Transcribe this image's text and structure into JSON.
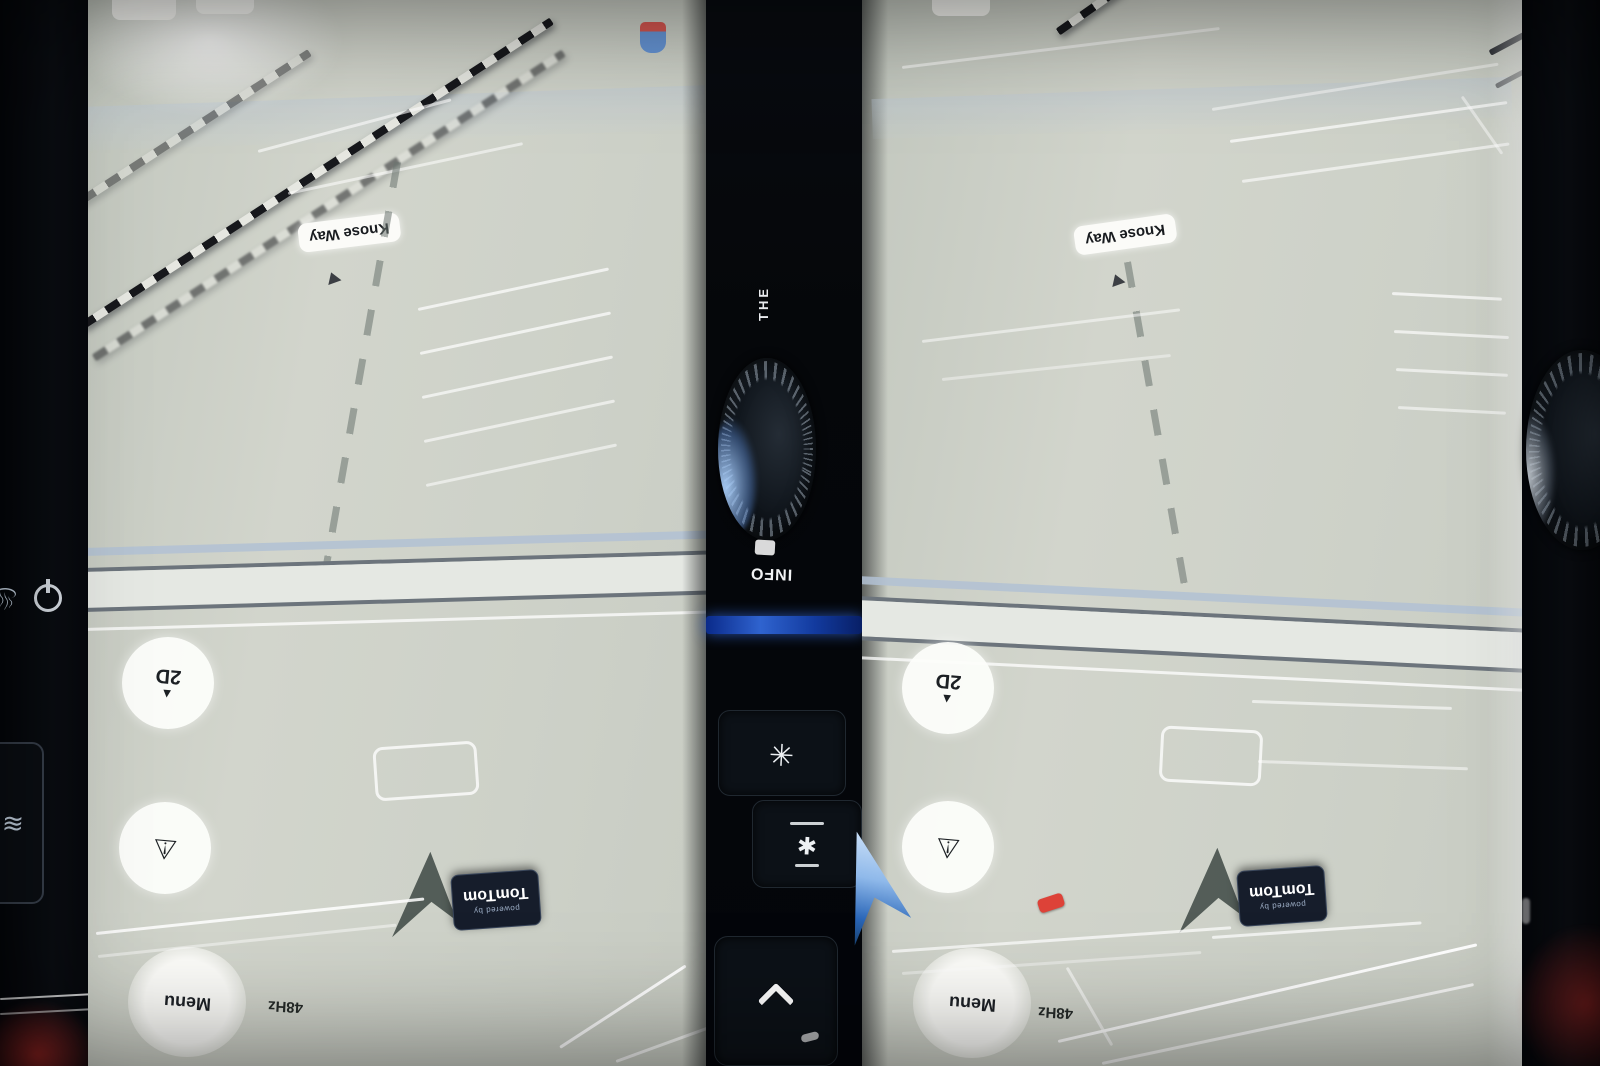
{
  "colors": {
    "map_background": "#cdd1c7",
    "bezel_black": "#06080b",
    "accent_blue": "#2f63cf",
    "chevron_blue": "#8fb9ea",
    "badge_background": "#161d2b",
    "alert_red": "#d84a44"
  },
  "map": {
    "road_label": "Knose Way",
    "compass_button_label": "2D",
    "menu_button_label": "Menu",
    "status_text": "48Hz",
    "badge_powered_by": "powered by",
    "badge_brand": "TomTom"
  },
  "console": {
    "vertical_text": "THE",
    "info_label": "INFO"
  },
  "icons": {
    "north_arrow": "▲",
    "hazard": "⚠",
    "defrost": "≋",
    "seat_heat": "♨",
    "console_button_top": "✳",
    "console_button_bottom": "✱"
  }
}
